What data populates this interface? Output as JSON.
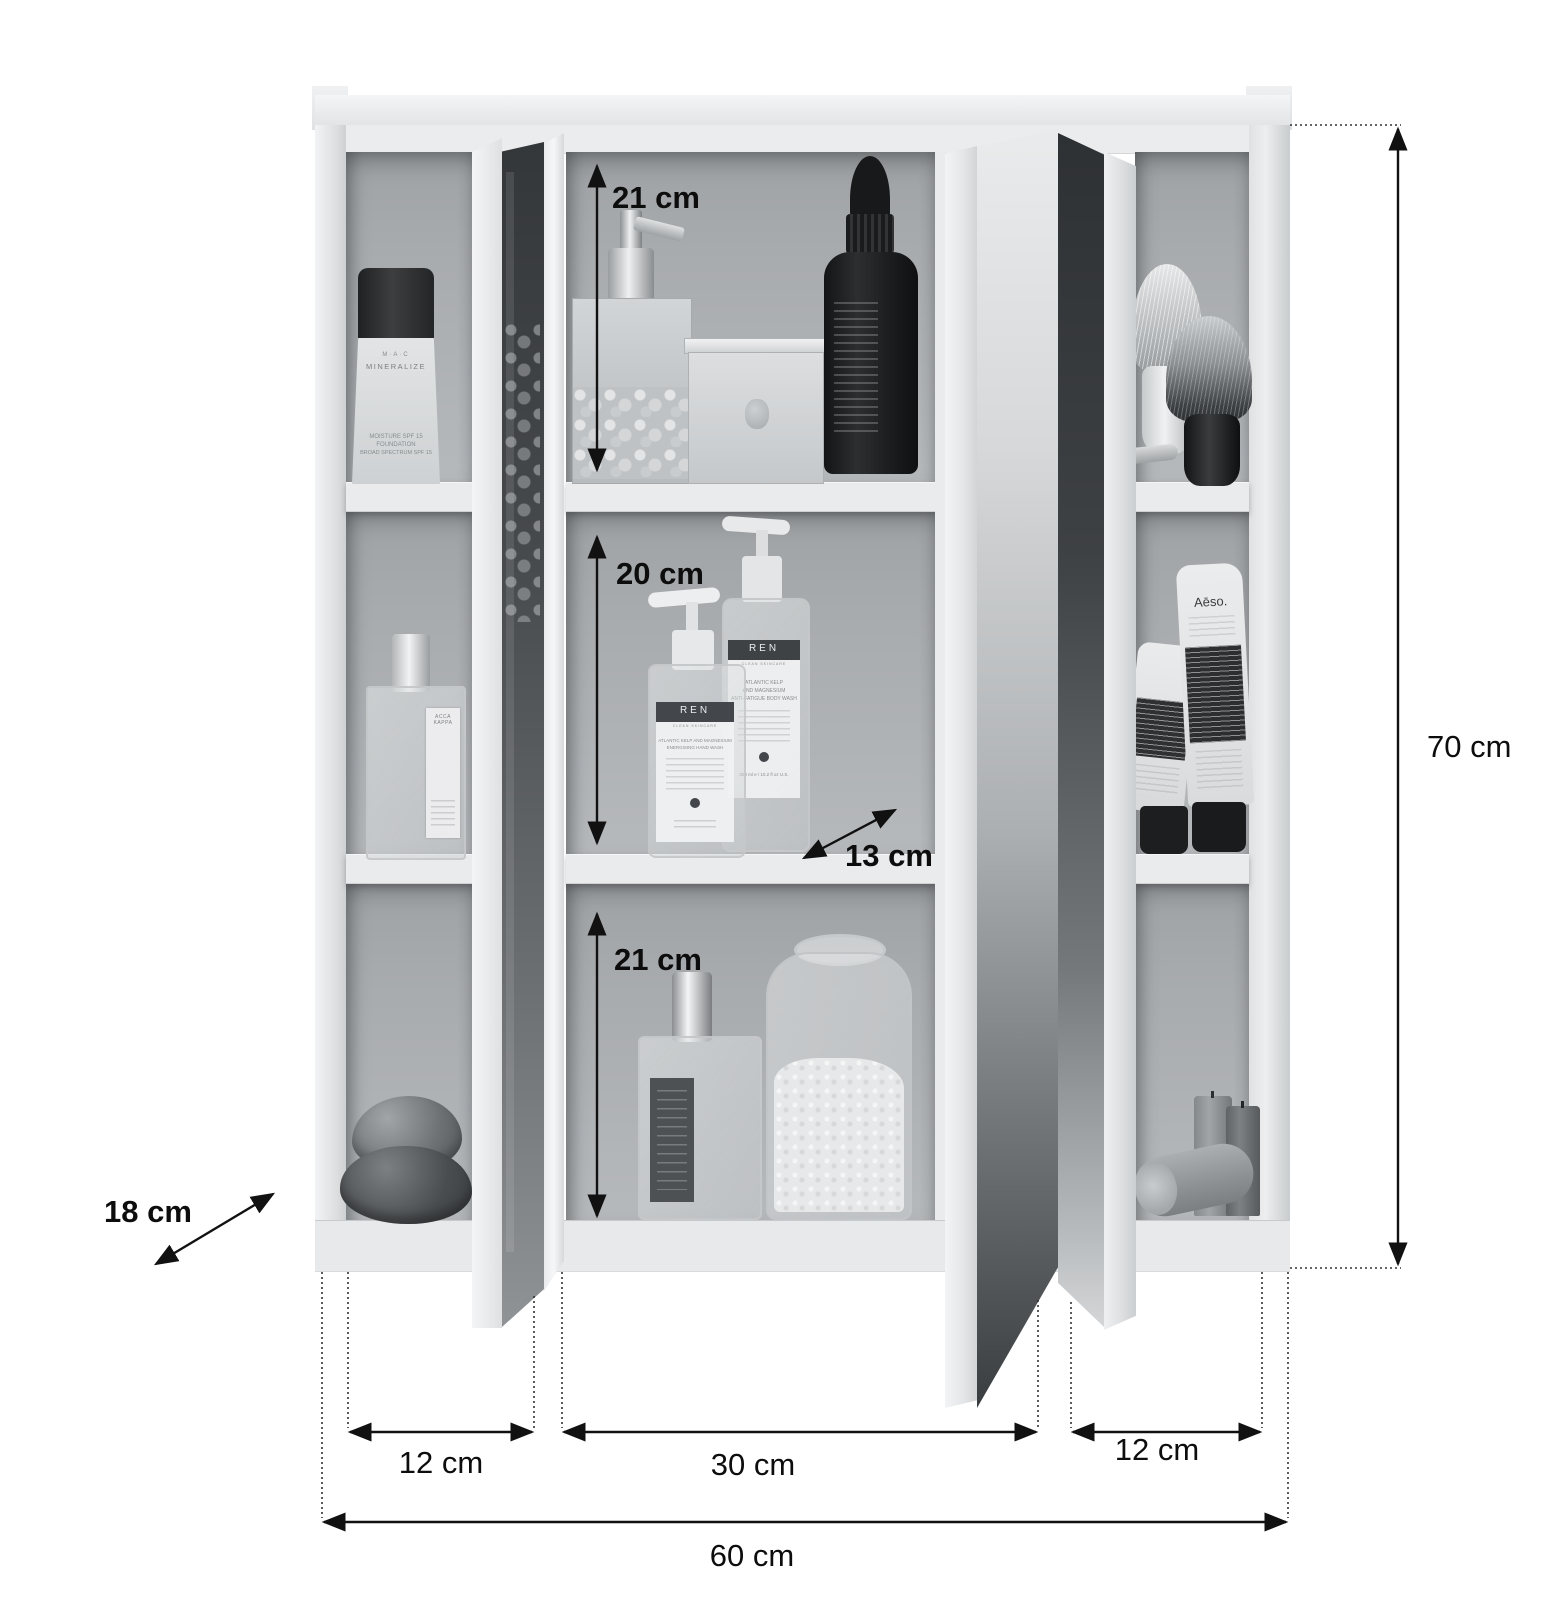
{
  "scene": {
    "type": "furniture-dimension-diagram",
    "subject": "3-door mirrored bathroom wall cabinet with toiletries",
    "background_color": "#ffffff",
    "annotation_color": "#111111",
    "cabinet_color": "#e9ebec",
    "mirror_color": "#3c3f42"
  },
  "dimensions": {
    "top_shelf_height": "21 cm",
    "middle_shelf_height": "20 cm",
    "shelf_depth": "13 cm",
    "bottom_shelf_height": "21 cm",
    "cabinet_height": "70 cm",
    "cabinet_depth": "18 cm",
    "left_compartment_width": "12 cm",
    "center_compartment_width": "30 cm",
    "right_compartment_width": "12 cm",
    "cabinet_width": "60 cm"
  },
  "products": {
    "mac_foundation": {
      "brand": "M·A·C",
      "line": "MINERALIZE",
      "desc1": "MOISTURE SPF 15",
      "desc2": "FOUNDATION",
      "desc3": "BROAD SPECTRUM SPF 15"
    },
    "ren_hand_wash": {
      "brand": "REN",
      "sub": "CLEAN SKINCARE",
      "desc1": "ATLANTIC KELP AND MAGNESIUM",
      "desc2": "ENERGISING HAND WASH"
    },
    "ren_body_wash": {
      "brand": "REN",
      "sub": "CLEAN SKINCARE",
      "desc1": "ATLANTIC KELP",
      "desc2": "AND MAGNESIUM",
      "desc3": "ANTI-FATIGUE BODY WASH",
      "size": "300 ml e / 10.2 fl oz U.S."
    },
    "aesop": {
      "brand": "Aēso."
    },
    "acca_kappa": {
      "brand": "ACCA KAPPA"
    }
  }
}
